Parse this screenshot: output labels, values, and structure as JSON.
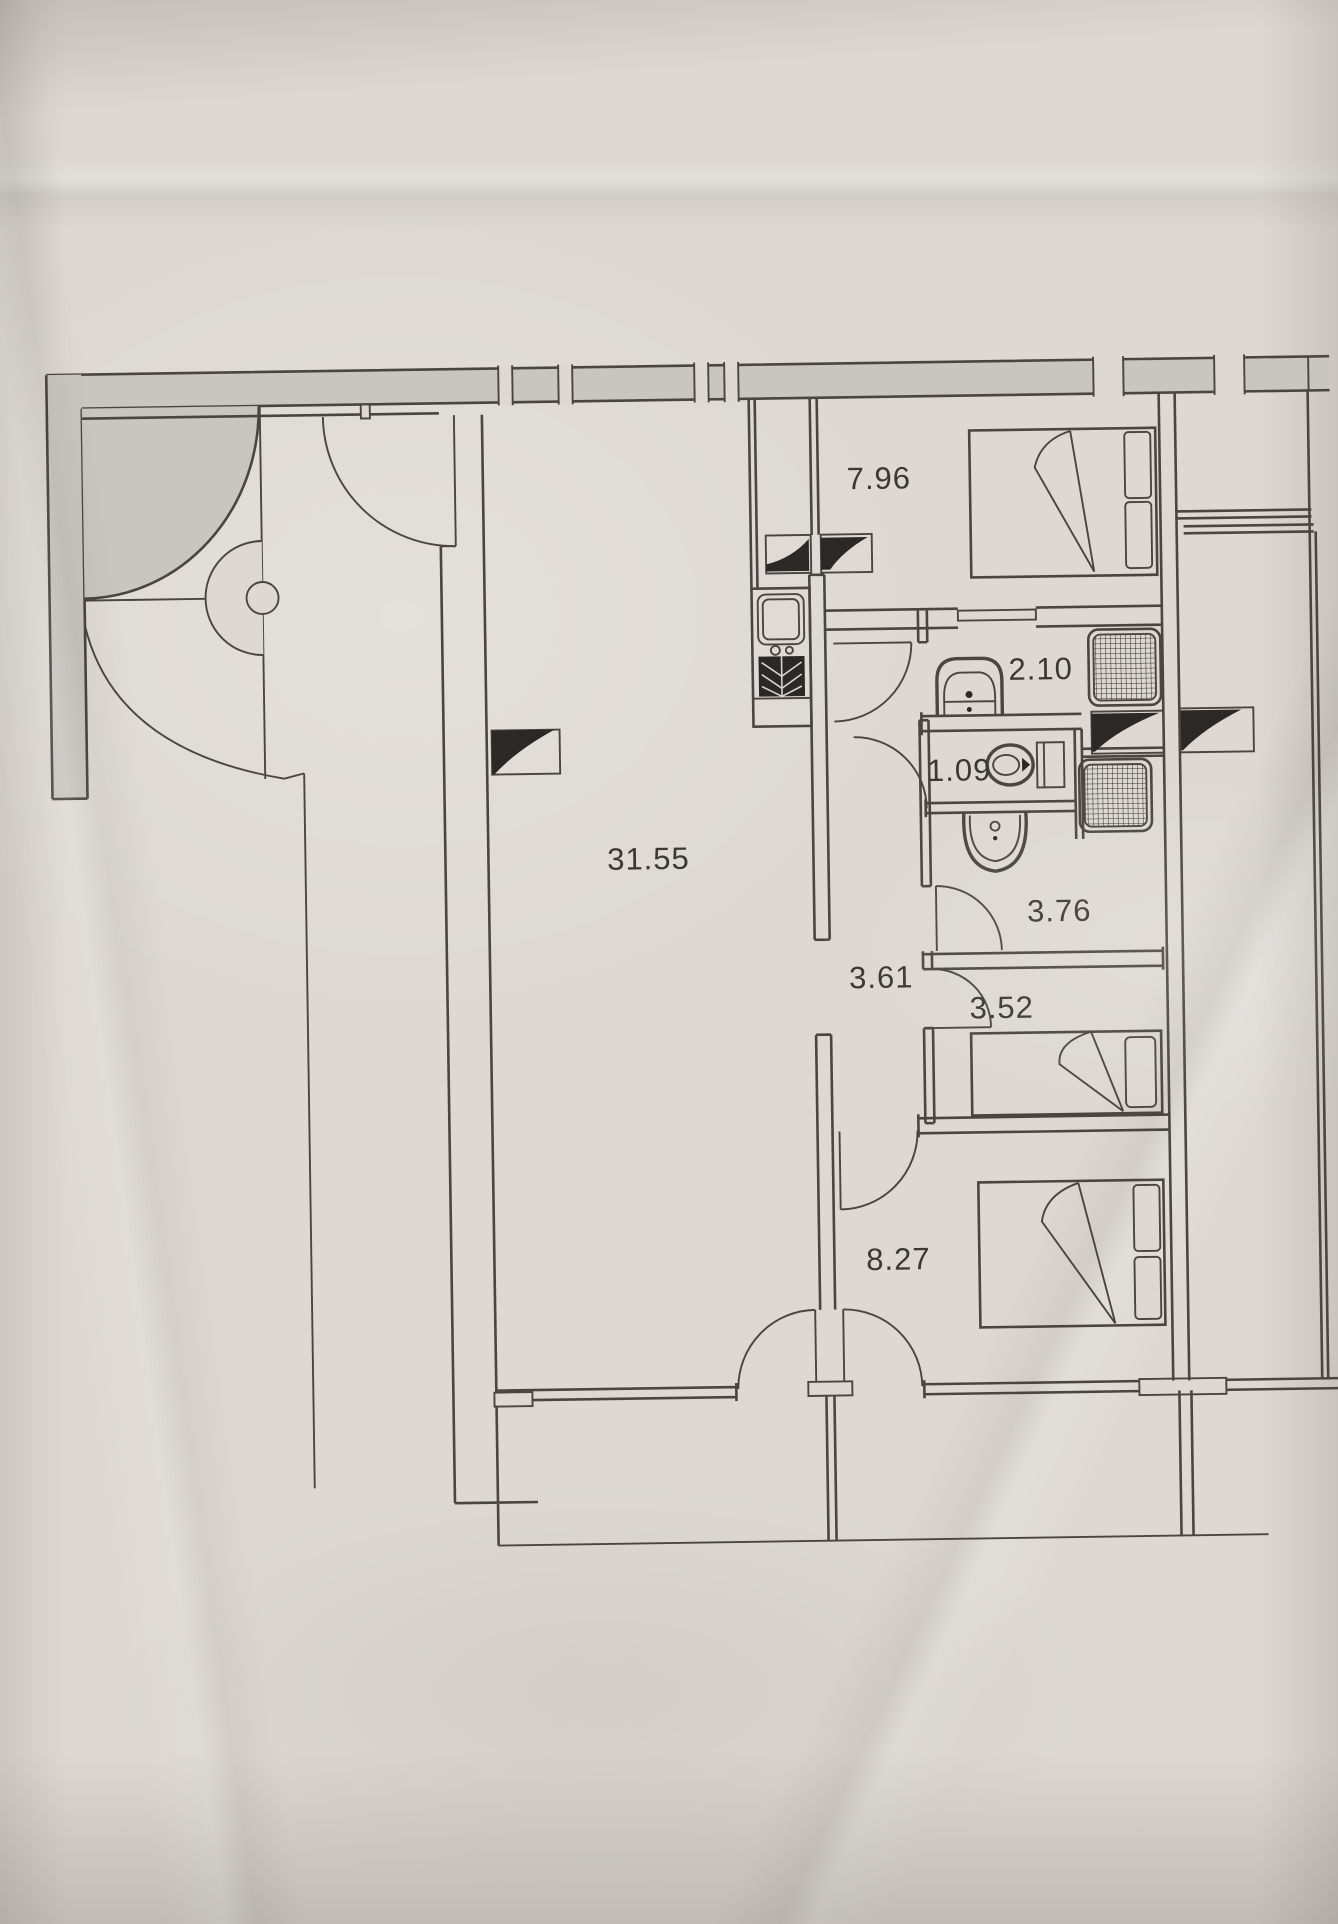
{
  "plan": {
    "kind": "architectural floor plan, photographed on paper",
    "units": "m2"
  },
  "rooms": [
    {
      "id": "living-room",
      "area": "31.55"
    },
    {
      "id": "bedroom-top",
      "area": "7.96"
    },
    {
      "id": "bathroom-top",
      "area": "2.10"
    },
    {
      "id": "wc",
      "area": "1.09"
    },
    {
      "id": "bathroom-bottom",
      "area": "3.76"
    },
    {
      "id": "hallway",
      "area": "3.61"
    },
    {
      "id": "bedroom-middle",
      "area": "3.52"
    },
    {
      "id": "bedroom-bottom",
      "area": "8.27"
    }
  ],
  "fixtures": [
    "double-bed",
    "single-bed",
    "pillow",
    "kitchen-sink",
    "shower-tray",
    "toilet",
    "cistern",
    "washbasin",
    "vent-shaft-wedge",
    "door-swing",
    "sliding-door",
    "curved-wall",
    "pivot-column",
    "window-joint"
  ],
  "colors": {
    "paper": "#ddd8d3",
    "line": "#4a4541",
    "wall_fill": "#c9c5c1",
    "dark_fill": "#2b2825",
    "label_text": "#3b3734"
  }
}
